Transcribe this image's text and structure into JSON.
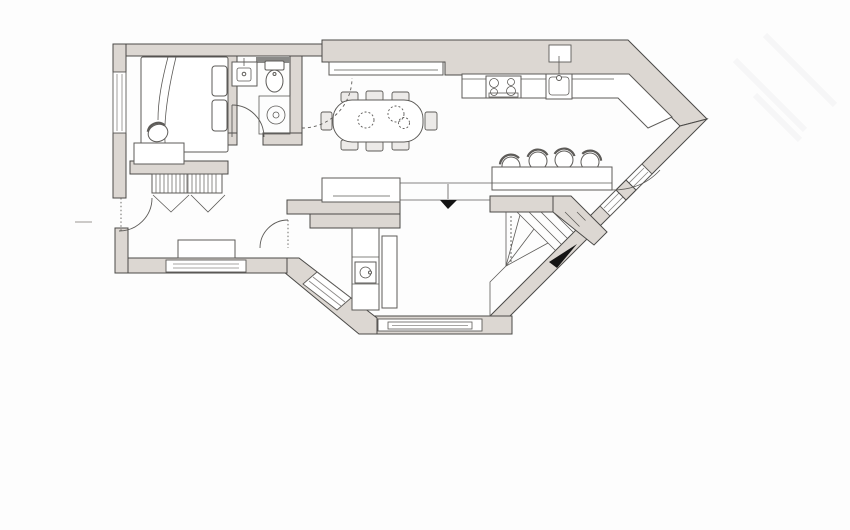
{
  "plan": {
    "colors": {
      "background": "#fdfdfd",
      "wall_fill": "#dcd7d2",
      "wall_stroke": "#4b4a48",
      "furniture_stroke": "#5d5b58",
      "dark_band": "#8a8a88",
      "accent_black": "#141414"
    },
    "features": [
      "bed",
      "pillows",
      "desk",
      "desk-chair",
      "wardrobe-hatched",
      "washbasin",
      "toilet",
      "shower",
      "bathroom-door",
      "dining-table",
      "dining-chairs-8",
      "table-decor",
      "sideboard",
      "kitchen-counter",
      "cooktop-4-burner",
      "kitchen-sink",
      "bar-counter",
      "bar-stools-4",
      "utility-cabinets",
      "utility-sink",
      "tall-cabinet",
      "hall-bench",
      "entry-door-swing",
      "utility-door-swing",
      "living-door-swing-dashed",
      "staircase-winder",
      "stairs-direction-arrow",
      "entrance-direction-arrow",
      "windows",
      "glazed-diagonal-door",
      "exterior-tick-mark",
      "watermark"
    ],
    "arrow_count": 2,
    "stool_count": 4,
    "dining_chair_count": 8
  }
}
